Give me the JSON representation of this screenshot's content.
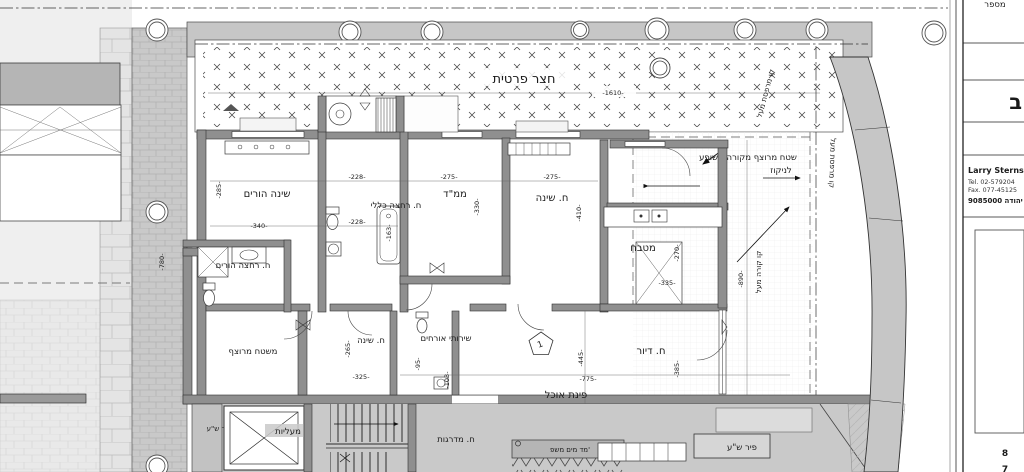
{
  "sheet": {
    "yard_label": "חצר פרטית",
    "rooms": {
      "parents_bedroom": "שינה הורים",
      "general_bathroom": "ח. רחצה כללי",
      "parents_bathroom": "ח. רחצה הורים",
      "mamad": "ממ\"ד",
      "bedroom_top": "ח. שינה",
      "kitchen": "מטבח",
      "living": "ח. דיור",
      "dining": "פינת אוכל",
      "bedroom_bottom": "ח. שינה",
      "guest_wc": "שירותי אורחים",
      "paved_deck": "משטח מרוצף",
      "elevators": "מעליות",
      "stairwell": "ח. מדרגות",
      "shaft_left": "פיר ש\"ע",
      "shaft_right": "פיר ש\"ע",
      "water_meter": "מד מים משפ'"
    },
    "annotations": {
      "covered_area_line1": "שטח מרוצף מקורה משופע",
      "covered_area_line2": "לניקוז",
      "balcony_line_above_1": "קו מרפסת מעל",
      "balcony_line_above_2": "קו מרפסת מעל",
      "beam_line_above": "קו קורה מעל",
      "level_marker": "1"
    },
    "dims": {
      "yard_width": "-1610-",
      "pb_depth": "-285-",
      "pb_width": "-340-",
      "gb_width_top": "-228-",
      "gb_width_bot": "-228-",
      "gb_height": "-163-",
      "mamad_width": "-275-",
      "mamad_depth": "-330-",
      "b2_width": "-275-",
      "b2_depth": "-410-",
      "kit_depth": "-270-",
      "kit_width": "-335-",
      "liv_depth": "-445-",
      "liv_width": "-775-",
      "liv_right": "-385-",
      "b3_depth": "-265-",
      "b3_width": "-325-",
      "wc_width": "-95-",
      "wc_height": "-103-",
      "balcony_len": "-890-",
      "walkway_len": "-780-"
    }
  },
  "title_block": {
    "number_label": "מספר",
    "block_letter": "ב",
    "name": "Larry Sterns",
    "tel": "Tel. 02-579204",
    "fax": "Fax. 077-45125",
    "address": "9085000 יהודה",
    "page_top": "8",
    "page_bottom": "7"
  }
}
